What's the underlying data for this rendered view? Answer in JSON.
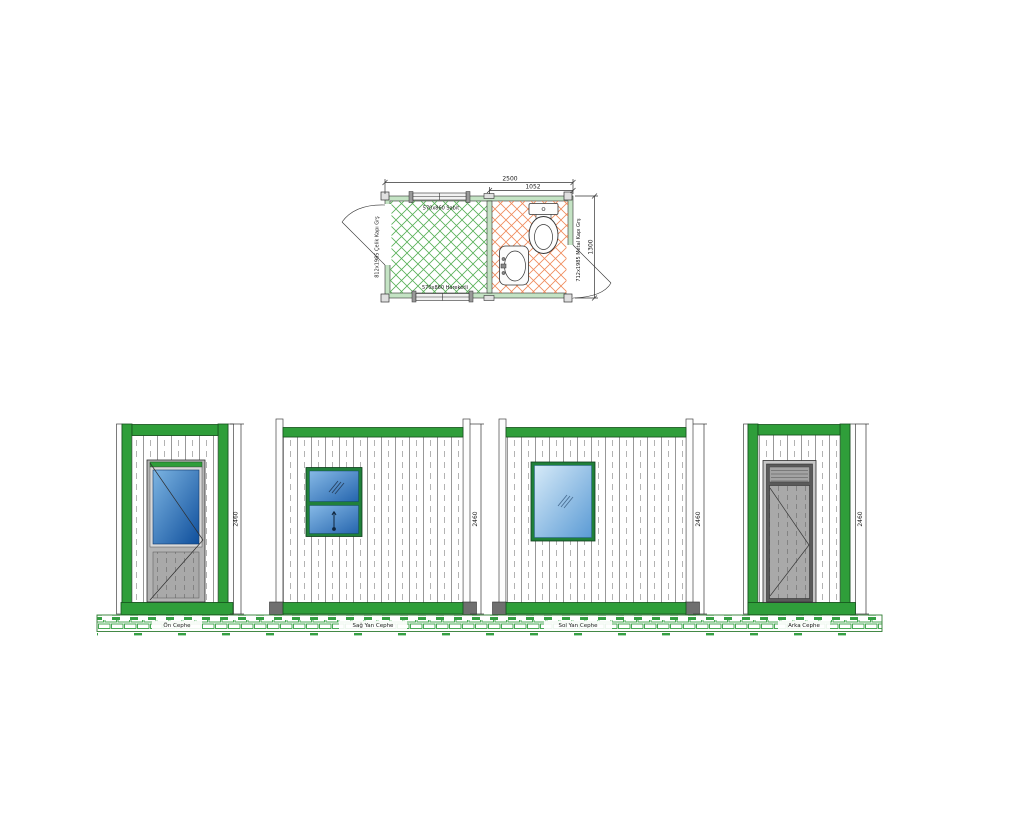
{
  "drawing": {
    "plan": {
      "dim_length": "2500",
      "dim_wc": "1052",
      "dim_width": "1300",
      "label_window_top": "570x860 Sabit",
      "label_window_bottom": "570x860 Hareketli",
      "label_door_left": "812x1985 Çelik Kapı Grş",
      "label_door_right": "712x1985 Metal Kapı Grş"
    },
    "elevations": {
      "front": {
        "label": "Ön Cephe",
        "dim": "2460"
      },
      "right": {
        "label": "Sağ Yan Cephe",
        "dim": "2460"
      },
      "left": {
        "label": "Sol Yan Cephe",
        "dim": "2460"
      },
      "back": {
        "label": "Arka Cephe",
        "dim": "2460"
      }
    },
    "colors": {
      "frame_green": "#2f9e3a",
      "hatch_green": "#58b058",
      "hatch_orange": "#ef8a5a",
      "brick_green": "#35a043",
      "glass_blue_dark": "#0f4f9c",
      "glass_blue_light": "#d6eaf8",
      "door_gray": "#a9a9a9"
    }
  }
}
